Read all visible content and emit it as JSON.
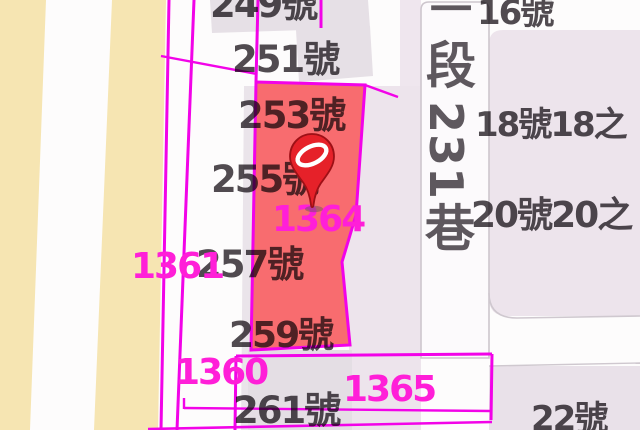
{
  "map": {
    "street_label": {
      "full": "一段231巷",
      "chars": [
        "一",
        "段",
        "231",
        "巷"
      ]
    },
    "address_labels": [
      {
        "text": "249號"
      },
      {
        "text": "251號"
      },
      {
        "text": "253號"
      },
      {
        "text": "255號"
      },
      {
        "text": "257號"
      },
      {
        "text": "259號"
      },
      {
        "text": "261號"
      },
      {
        "text": "16號"
      },
      {
        "text": "18號18之"
      },
      {
        "text": "20號20之"
      },
      {
        "text": "22號"
      }
    ],
    "parcel_numbers": [
      {
        "text": "1361"
      },
      {
        "text": "1364"
      },
      {
        "text": "1360"
      },
      {
        "text": "1365"
      }
    ],
    "selected_parcel": {
      "id": "1364",
      "marker": "location-pin"
    },
    "colors": {
      "parcel_highlight": "#f75f63",
      "boundary_magenta": "#f203e8",
      "parcel_number_text": "#ff1fd8",
      "address_text": "#514c51",
      "field_stripe": "#f6e5b2",
      "road_fill": "#fcfafc",
      "block_fill": "#ede4ec",
      "pin_red": "#e62129"
    }
  }
}
